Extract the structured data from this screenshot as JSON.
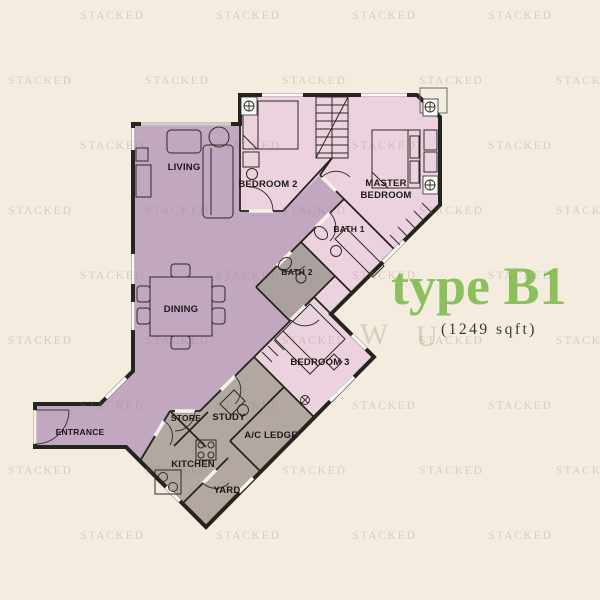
{
  "title": {
    "type": "type B1",
    "area": "(1249 sqft)"
  },
  "rooms": {
    "living": {
      "label": "LIVING"
    },
    "dining": {
      "label": "DINING"
    },
    "bedroom2": {
      "label": "BEDROOM 2"
    },
    "master": {
      "label": "MASTER",
      "label2": "BEDROOM"
    },
    "bath1": {
      "label": "BATH 1"
    },
    "bath2": {
      "label": "BATH 2"
    },
    "bedroom3": {
      "label": "BEDROOM 3"
    },
    "study": {
      "label": "STUDY"
    },
    "store": {
      "label": "STORE"
    },
    "acledge": {
      "label": "A/C LEDGE"
    },
    "kitchen": {
      "label": "KITCHEN"
    },
    "yard": {
      "label": "YARD"
    },
    "entrance": {
      "label": "ENTRANCE"
    }
  },
  "watermark": {
    "text": "STACKED",
    "rows": [
      {
        "y": 10,
        "xs": [
          80,
          216,
          352,
          488
        ]
      },
      {
        "y": 75,
        "xs": [
          8,
          145,
          282,
          419,
          556
        ]
      },
      {
        "y": 140,
        "xs": [
          80,
          216,
          352,
          488
        ]
      },
      {
        "y": 205,
        "xs": [
          8,
          145,
          282,
          419,
          556
        ]
      },
      {
        "y": 270,
        "xs": [
          80,
          216,
          352,
          488
        ]
      },
      {
        "y": 335,
        "xs": [
          8,
          145,
          282,
          419,
          556
        ]
      },
      {
        "y": 400,
        "xs": [
          80,
          216,
          352,
          488
        ]
      },
      {
        "y": 465,
        "xs": [
          8,
          145,
          282,
          419,
          556
        ]
      },
      {
        "y": 530,
        "xs": [
          80,
          216,
          352,
          488
        ]
      }
    ],
    "big_letters": [
      {
        "ch": "W",
        "x": 360,
        "y": 318
      },
      {
        "ch": "U",
        "x": 416,
        "y": 320
      }
    ]
  },
  "colors": {
    "cream": "#f3ecdf",
    "mauve": "#c2a7c1",
    "pink": "#ecd2de",
    "gray": "#b3a7a2",
    "bath_gray": "#aba09d",
    "wall": "#26241f",
    "window_white": "#fcfaf5",
    "door_white": "#f6f1e8",
    "green_title": "#8cc05e",
    "area_text": "#3b3933",
    "label_text": "#1a1916",
    "watermark": "rgba(148,136,110,0.30)",
    "furn": "#2b2a28"
  }
}
